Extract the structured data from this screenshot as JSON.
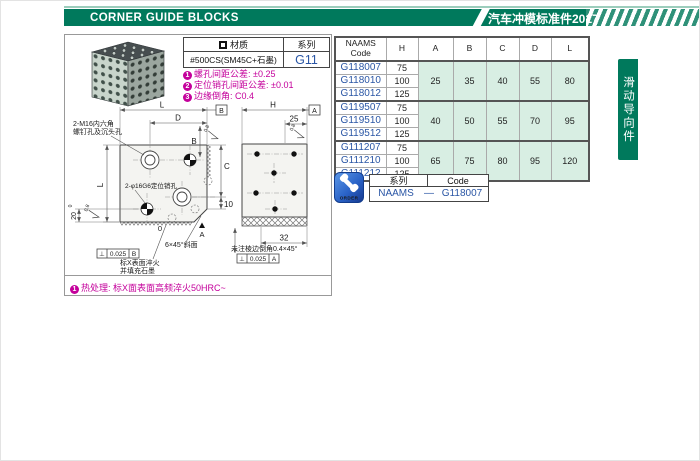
{
  "header": {
    "title": "CORNER GUIDE BLOCKS",
    "edition": "汽车冲模标准件2017"
  },
  "side_tab": "滑动导向件",
  "material": {
    "material_label": "材质",
    "series_label": "系列",
    "material_value": "#500CS(SM45C+石墨)",
    "series_value": "G11"
  },
  "notes": [
    {
      "num": "1",
      "text": "螺孔间距公差: ±0.25"
    },
    {
      "num": "2",
      "text": "定位销孔间距公差: ±0.01"
    },
    {
      "num": "3",
      "text": "边缘倒角: C0.4"
    }
  ],
  "heat_note": {
    "num": "1",
    "text": "热处理: 标X面表面高频淬火50HRC~"
  },
  "drawing": {
    "front": {
      "dim_top": "L",
      "dim_d": "D",
      "dim_b": "B",
      "dim_c": "C",
      "dim_10": "10",
      "dim_left": "L",
      "dim_20": "20",
      "tol_sup": "0",
      "zero": "0",
      "datum_a": "A",
      "datum_flag_b": "B",
      "screw_label_1": "2-M16内六角",
      "screw_label_2": "螺钉孔及沉头孔",
      "dowel_label": "2-φ16G6定位销孔",
      "bevel_label": "6×45°斜面",
      "surface_note_1": "标X表面淬火",
      "surface_note_2": "并填充石墨",
      "roughness": "0.8",
      "tol_frame": {
        "symbol": "⊥",
        "value": "0.025",
        "datum": "B"
      }
    },
    "side": {
      "dim_h": "H",
      "datum_flag_a": "A",
      "dim_25": "25",
      "dim_32": "32",
      "chamfer_note": "未注棱边倒角0.4×45°",
      "roughness": "0.8",
      "tol_frame": {
        "symbol": "⊥",
        "value": "0.025",
        "datum": "A"
      }
    }
  },
  "spec_table": {
    "headers": {
      "code": "NAAMS\nCode",
      "h": "H",
      "a": "A",
      "b": "B",
      "c": "C",
      "d": "D",
      "l": "L"
    },
    "groups": [
      {
        "rows": [
          {
            "code": "G118007",
            "h": "75"
          },
          {
            "code": "G118010",
            "h": "100"
          },
          {
            "code": "G118012",
            "h": "125"
          }
        ],
        "a": "25",
        "b": "35",
        "c": "40",
        "d": "55",
        "l": "80"
      },
      {
        "rows": [
          {
            "code": "G119507",
            "h": "75"
          },
          {
            "code": "G119510",
            "h": "100"
          },
          {
            "code": "G119512",
            "h": "125"
          }
        ],
        "a": "40",
        "b": "50",
        "c": "55",
        "d": "70",
        "l": "95"
      },
      {
        "rows": [
          {
            "code": "G111207",
            "h": "75"
          },
          {
            "code": "G111210",
            "h": "100"
          },
          {
            "code": "G111212",
            "h": "125"
          }
        ],
        "a": "65",
        "b": "75",
        "c": "80",
        "d": "95",
        "l": "120"
      }
    ]
  },
  "order": {
    "icon_label": "ORDER",
    "series_label": "系列",
    "code_label": "Code",
    "series_value": "NAAMS",
    "separator": "—",
    "code_value": "G118007"
  },
  "colors": {
    "accent_green": "#00795c",
    "table_mint": "#d8eee3",
    "link_blue": "#2a56a5",
    "note_magenta": "#c4009b",
    "order_blue": "#2a63c8"
  }
}
